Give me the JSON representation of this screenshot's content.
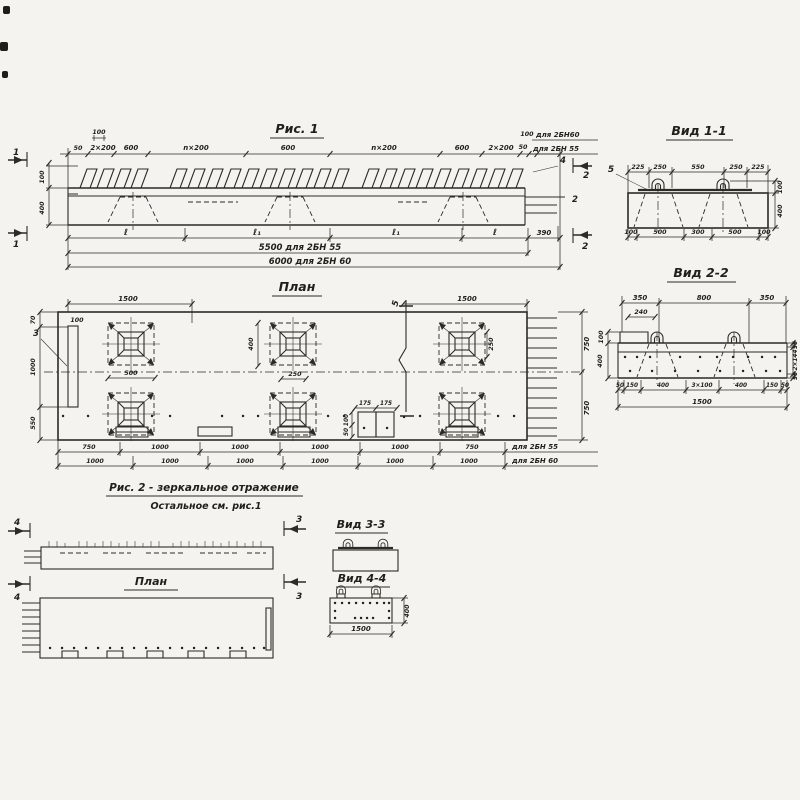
{
  "palette": {
    "paper": "#f4f3ef",
    "ink": "#2c2b26"
  },
  "fig1": {
    "title": "Рис. 1",
    "sec1": "1",
    "sec2": "2",
    "pos2": "2",
    "pos4": "4",
    "top": [
      "100",
      "50",
      "2×200",
      "600",
      "n×200",
      "600",
      "n×200",
      "600",
      "2×200",
      "50",
      "100"
    ],
    "note60": "для 2БН60",
    "note55": "для 2БН 55",
    "left": [
      "100",
      "400"
    ],
    "bot": [
      "ℓ",
      "ℓ₁",
      "ℓ₁",
      "ℓ",
      "390"
    ],
    "tot55": "5500 для 2БН 55",
    "tot60": "6000 для 2БН 60"
  },
  "view11": {
    "title": "Вид 1-1",
    "pos5": "5",
    "top": [
      "225",
      "250",
      "550",
      "250",
      "225"
    ],
    "right": [
      "100",
      "400"
    ],
    "bot": [
      "100",
      "500",
      "300",
      "500",
      "100"
    ]
  },
  "view22": {
    "title": "Вид 2-2",
    "top": [
      "350",
      "800",
      "350"
    ],
    "d240": "240",
    "left": [
      "100",
      "400"
    ],
    "right": [
      "56",
      "2×144",
      "56"
    ],
    "bot": [
      "50",
      "150",
      "400",
      "3×100",
      "400",
      "150",
      "50"
    ],
    "total": "1500"
  },
  "plan": {
    "title": "План",
    "dim1500l": "1500",
    "dim1500r": "1500",
    "sec5": "5",
    "pos3": "3",
    "d100": "100",
    "left": [
      "70",
      "1000",
      "550"
    ],
    "sq": [
      "500",
      "400",
      "250",
      "250"
    ],
    "mid": [
      "175",
      "175",
      "100",
      "50"
    ],
    "right": [
      "750",
      "750"
    ],
    "row55": [
      "750",
      "1000",
      "1000",
      "1000",
      "1000",
      "750"
    ],
    "row60": [
      "1000",
      "1000",
      "1000",
      "1000",
      "1000",
      "1000"
    ],
    "note55": "для 2БН 55",
    "note60": "для 2БН 60"
  },
  "fig2": {
    "caption": "Рис. 2 - зеркальное отражение",
    "caption2": "Остальное см. рис.1",
    "plan_title": "План",
    "sec3": "3",
    "sec4": "4"
  },
  "view33": {
    "title": "Вид 3-3"
  },
  "view44": {
    "title": "Вид 4-4",
    "d400": "400",
    "d1500": "1500"
  }
}
